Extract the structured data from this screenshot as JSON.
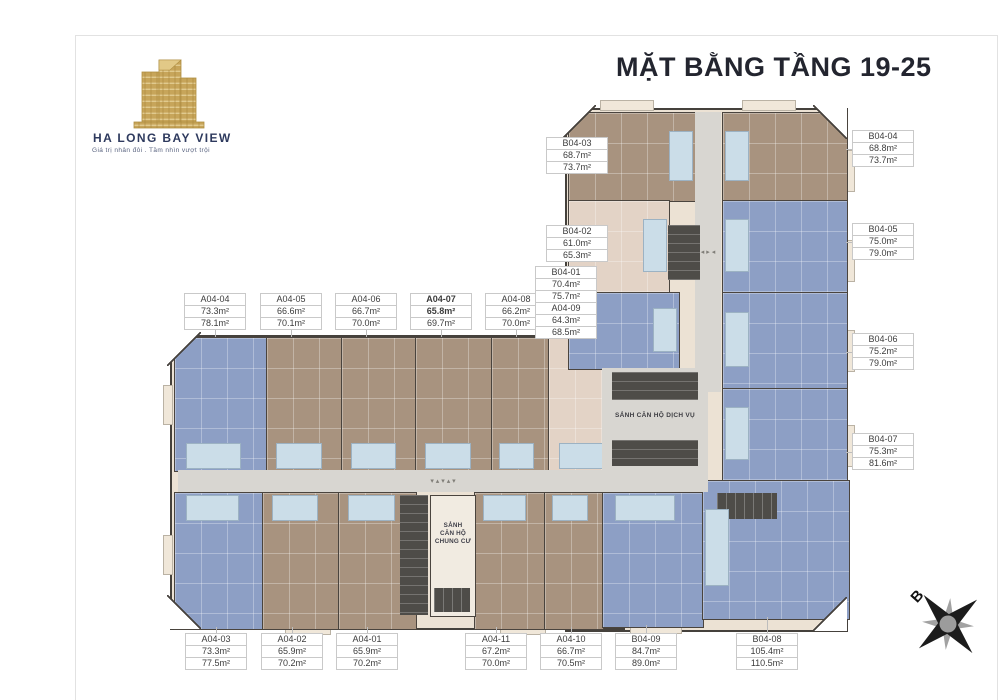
{
  "title": "MẶT BẰNG TẦNG 19-25",
  "brand": {
    "name": "HA LONG BAY VIEW",
    "tagline": "Giá trị nhân đôi . Tầm nhìn vượt trội"
  },
  "compass": {
    "north_label": "B"
  },
  "lobbies": {
    "service": "SẢNH CĂN HỘ DỊCH VỤ",
    "residential_lines": [
      "SẢNH",
      "CĂN HỘ",
      "CHUNG CƯ"
    ]
  },
  "units": [
    {
      "id": "A04-04",
      "area1": "73.3m²",
      "area2": "78.1m²"
    },
    {
      "id": "A04-05",
      "area1": "66.6m²",
      "area2": "70.1m²"
    },
    {
      "id": "A04-06",
      "area1": "66.7m²",
      "area2": "70.0m²"
    },
    {
      "id": "A04-07",
      "area1": "65.8m²",
      "area2": "69.7m²"
    },
    {
      "id": "A04-08",
      "area1": "66.2m²",
      "area2": "70.0m²"
    },
    {
      "id": "A04-09",
      "area1": "64.3m²",
      "area2": "68.5m²"
    },
    {
      "id": "B04-01",
      "area1": "70.4m²",
      "area2": "75.7m²"
    },
    {
      "id": "B04-03",
      "area1": "68.7m²",
      "area2": "73.7m²"
    },
    {
      "id": "B04-02",
      "area1": "61.0m²",
      "area2": "65.3m²"
    },
    {
      "id": "B04-04",
      "area1": "68.8m²",
      "area2": "73.7m²"
    },
    {
      "id": "B04-05",
      "area1": "75.0m²",
      "area2": "79.0m²"
    },
    {
      "id": "B04-06",
      "area1": "75.2m²",
      "area2": "79.0m²"
    },
    {
      "id": "B04-07",
      "area1": "75.3m²",
      "area2": "81.6m²"
    },
    {
      "id": "A04-03",
      "area1": "73.3m²",
      "area2": "77.5m²"
    },
    {
      "id": "A04-02",
      "area1": "65.9m²",
      "area2": "70.2m²"
    },
    {
      "id": "A04-01",
      "area1": "65.9m²",
      "area2": "70.2m²"
    },
    {
      "id": "A04-11",
      "area1": "67.2m²",
      "area2": "70.0m²"
    },
    {
      "id": "A04-10",
      "area1": "66.7m²",
      "area2": "70.5m²"
    },
    {
      "id": "B04-09",
      "area1": "84.7m²",
      "area2": "89.0m²"
    },
    {
      "id": "B04-08",
      "area1": "105.4m²",
      "area2": "110.5m²"
    }
  ],
  "colors": {
    "unit_brown": "#a8937f",
    "unit_blue": "#8d9fc5",
    "unit_beige": "#e3d3c6",
    "corridor": "#d8d6d1",
    "core_dark": "#4e4c48",
    "title_navy": "#23252f",
    "brand_gold": "#c7a55a"
  },
  "corridor_arrows": {
    "horizontal": "▾ ▴ ▾ ▴ ▾",
    "vertical": "◂ ▸ ◂"
  }
}
